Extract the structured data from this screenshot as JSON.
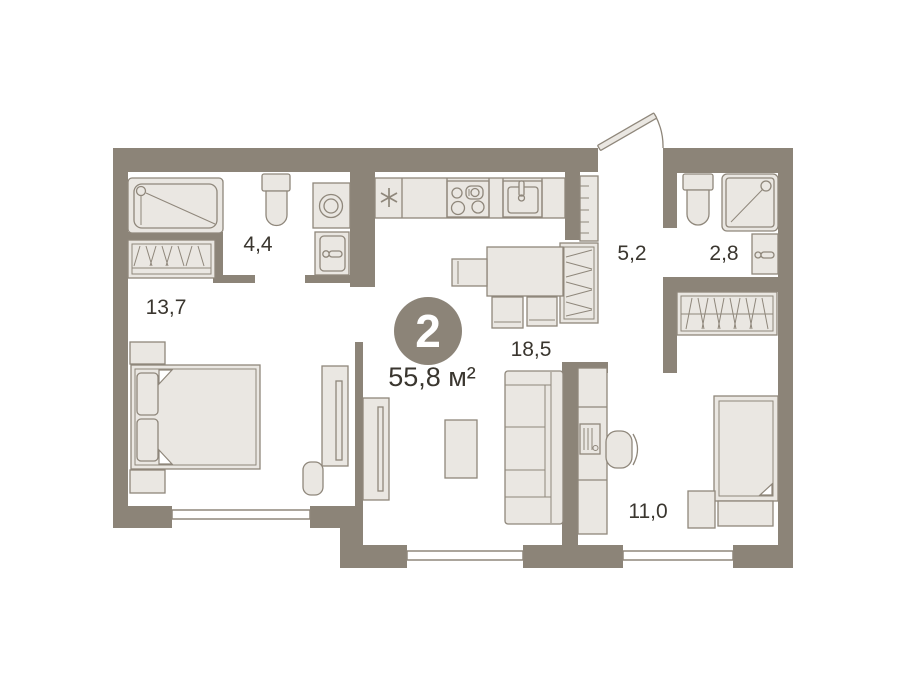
{
  "floorplan": {
    "badge": {
      "rooms_count": "2",
      "total_area": "55,8 м²"
    },
    "room_labels": {
      "bedroom_left": "13,7",
      "bathroom_left": "4,4",
      "hallway": "5,2",
      "bathroom_right": "2,8",
      "kitchen_living": "18,5",
      "bedroom_right": "11,0"
    },
    "fixtures": [
      "bathtub",
      "toilet",
      "washing-machine",
      "bathroom-sink",
      "fridge-asterisk",
      "stove",
      "kitchen-sink",
      "wardrobe",
      "shelf-unit",
      "dining-table",
      "chair",
      "sofa",
      "coffee-table",
      "tv-panel",
      "double-bed",
      "nightstand",
      "pouf",
      "single-bed",
      "desk",
      "desk-chair",
      "monitor",
      "shower-cabin",
      "entrance-door",
      "window"
    ],
    "colors": {
      "background": "#ffffff",
      "wall": "#8c8478",
      "furniture_fill": "#eae7e2",
      "furniture_stroke": "#8f877b",
      "badge_fill": "#8c8478",
      "badge_text": "#ffffff",
      "label_text": "#3a362f"
    }
  }
}
